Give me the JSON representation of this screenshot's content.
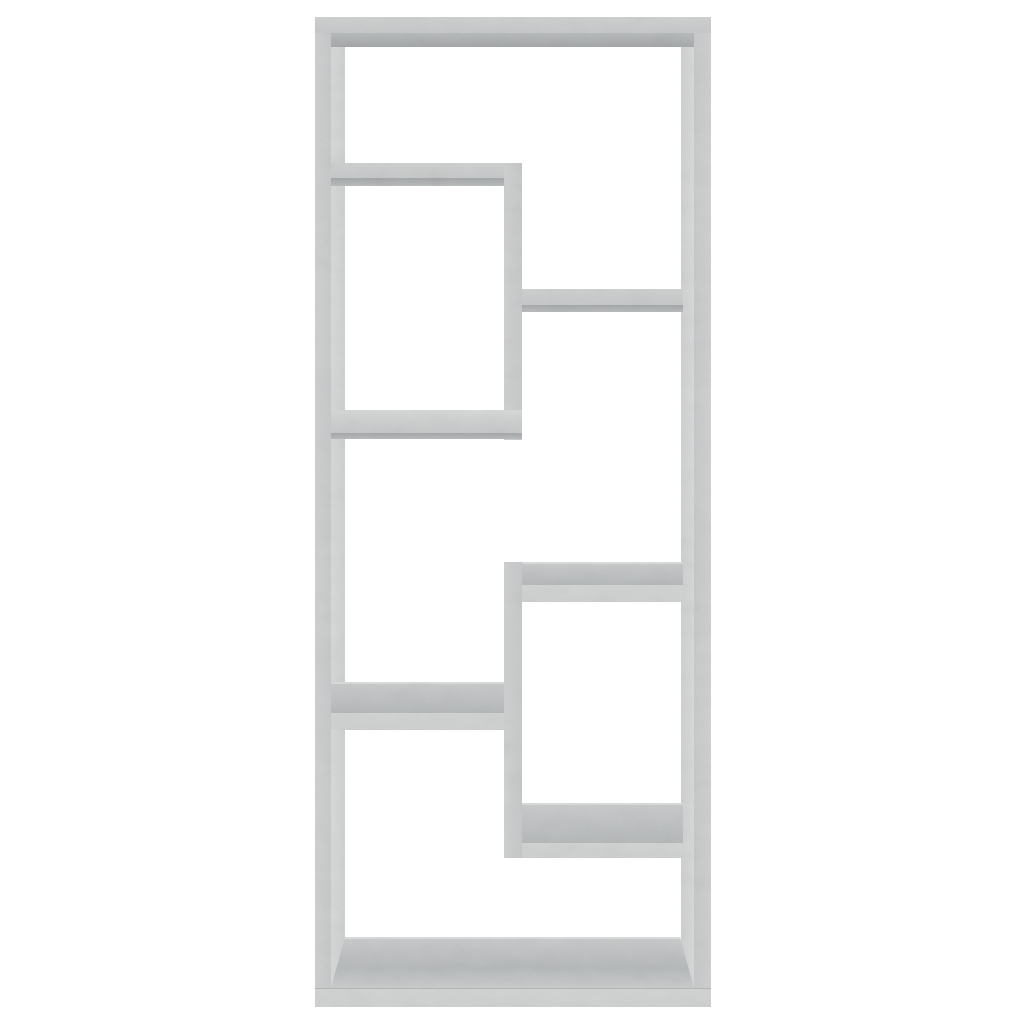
{
  "scene": {
    "description": "Product photo: wall-mounted open shelf unit in concrete gray, viewed straight on, centered on a plain white background",
    "background_color": "#ffffff"
  },
  "palette": {
    "background": "#ffffff",
    "board_front": "#c6c8c9",
    "board_front_light": "#cfd1d1",
    "board_front_lighter": "#d3d4d4",
    "board_inner": "#d8d9d9",
    "board_surface": "#b5b8b9",
    "board_surface_light": "#c9cbcc",
    "board_underside": "#a2a5a6",
    "board_underside_light": "#b7babb",
    "edge_highlight": "#dcdddd"
  },
  "shelf_unit": {
    "label": "Wall shelf, concrete gray",
    "material_look": "concrete gray chipboard",
    "compartment_count": 6,
    "bounding_box_px": {
      "x": 315,
      "y": 17,
      "w": 396,
      "h": 990
    },
    "parts": [
      {
        "name": "frame-left-front-face",
        "face": "front-v",
        "x": 315,
        "y": 17,
        "w": 16,
        "h": 990
      },
      {
        "name": "frame-left-inner-face",
        "face": "inner-l",
        "x": 331,
        "y": 17,
        "w": 14,
        "h": 990
      },
      {
        "name": "frame-right-inner-face",
        "face": "inner-r",
        "x": 681,
        "y": 17,
        "w": 13,
        "h": 990
      },
      {
        "name": "frame-right-front-face",
        "face": "front-v-r",
        "x": 694,
        "y": 17,
        "w": 17,
        "h": 990
      },
      {
        "name": "frame-top-front-face",
        "face": "front-h",
        "x": 315,
        "y": 17,
        "w": 396,
        "h": 16
      },
      {
        "name": "frame-top-underside",
        "face": "under-deep",
        "x": 331,
        "y": 33,
        "w": 363,
        "h": 14
      },
      {
        "name": "frame-bottom-top-surface",
        "face": "surface-trapezoid",
        "x": 331,
        "y": 937,
        "w": 363,
        "h": 51
      },
      {
        "name": "frame-bottom-front-face",
        "face": "front-light",
        "x": 315,
        "y": 988,
        "w": 396,
        "h": 19
      },
      {
        "name": "divider-upper",
        "face": "front-v",
        "x": 504,
        "y": 163,
        "w": 18,
        "h": 277
      },
      {
        "name": "shelf-a-front-face",
        "face": "front-h",
        "x": 331,
        "y": 163,
        "w": 173,
        "h": 15
      },
      {
        "name": "shelf-a-underside",
        "face": "under",
        "x": 331,
        "y": 178,
        "w": 173,
        "h": 8
      },
      {
        "name": "shelf-c-front-face",
        "face": "front-h",
        "x": 522,
        "y": 289,
        "w": 161,
        "h": 16
      },
      {
        "name": "shelf-c-underside",
        "face": "under",
        "x": 522,
        "y": 305,
        "w": 161,
        "h": 7
      },
      {
        "name": "shelf-b-top-edge",
        "face": "sliver",
        "x": 331,
        "y": 410,
        "w": 191,
        "h": 10
      },
      {
        "name": "shelf-b-front-face",
        "face": "front-h",
        "x": 331,
        "y": 420,
        "w": 191,
        "h": 13
      },
      {
        "name": "shelf-b-underside",
        "face": "under",
        "x": 331,
        "y": 433,
        "w": 191,
        "h": 6
      },
      {
        "name": "divider-lower",
        "face": "front-v",
        "x": 504,
        "y": 562,
        "w": 18,
        "h": 296
      },
      {
        "name": "shelf-e-top-surface",
        "face": "surface",
        "x": 522,
        "y": 562,
        "w": 161,
        "h": 22
      },
      {
        "name": "shelf-e-front-face",
        "face": "front-light",
        "x": 522,
        "y": 584,
        "w": 161,
        "h": 18
      },
      {
        "name": "shelf-d-top-surface",
        "face": "surface",
        "x": 331,
        "y": 682,
        "w": 173,
        "h": 30
      },
      {
        "name": "shelf-d-front-face",
        "face": "front-light",
        "x": 331,
        "y": 712,
        "w": 173,
        "h": 18
      },
      {
        "name": "shelf-f-top-surface",
        "face": "surface",
        "x": 522,
        "y": 803,
        "w": 161,
        "h": 39
      },
      {
        "name": "shelf-f-front-face",
        "face": "front-light",
        "x": 522,
        "y": 842,
        "w": 161,
        "h": 16
      }
    ]
  }
}
